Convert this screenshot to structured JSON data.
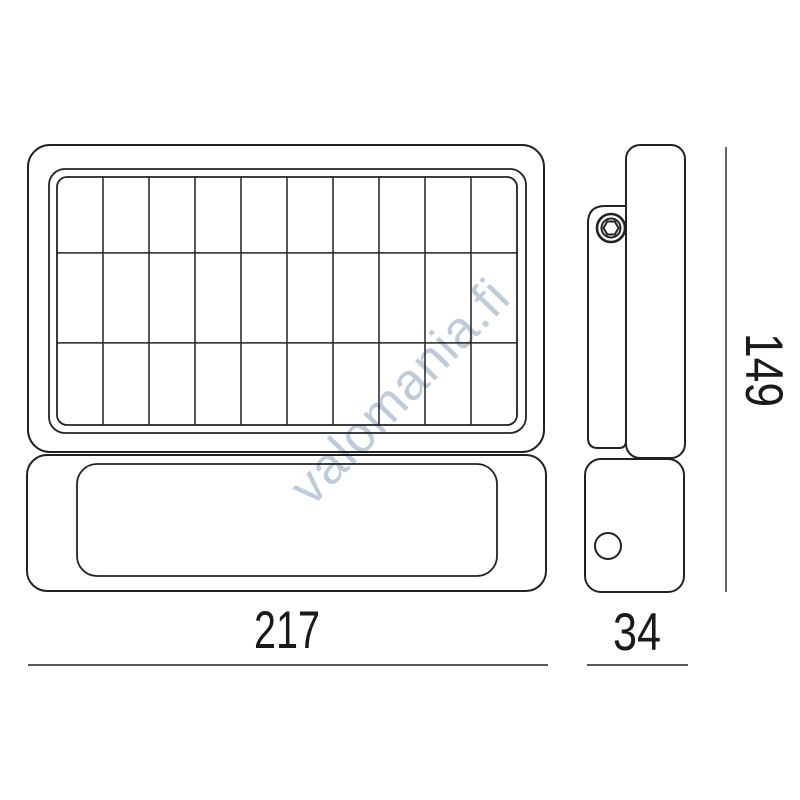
{
  "page": {
    "background_hex": "#ffffff"
  },
  "watermark": {
    "text": "valomania.fi",
    "color_hex": "#aebfd3"
  },
  "diagram": {
    "description": "solar floodlight dimension drawing, front and side views",
    "line_color_hex": "#222222",
    "dimension_text_color_hex": "#1a1a1a",
    "solar_grid": {
      "columns": 10,
      "rows": 3
    },
    "dimensions": {
      "front_width": "217",
      "side_depth": "34",
      "height": "149"
    }
  }
}
